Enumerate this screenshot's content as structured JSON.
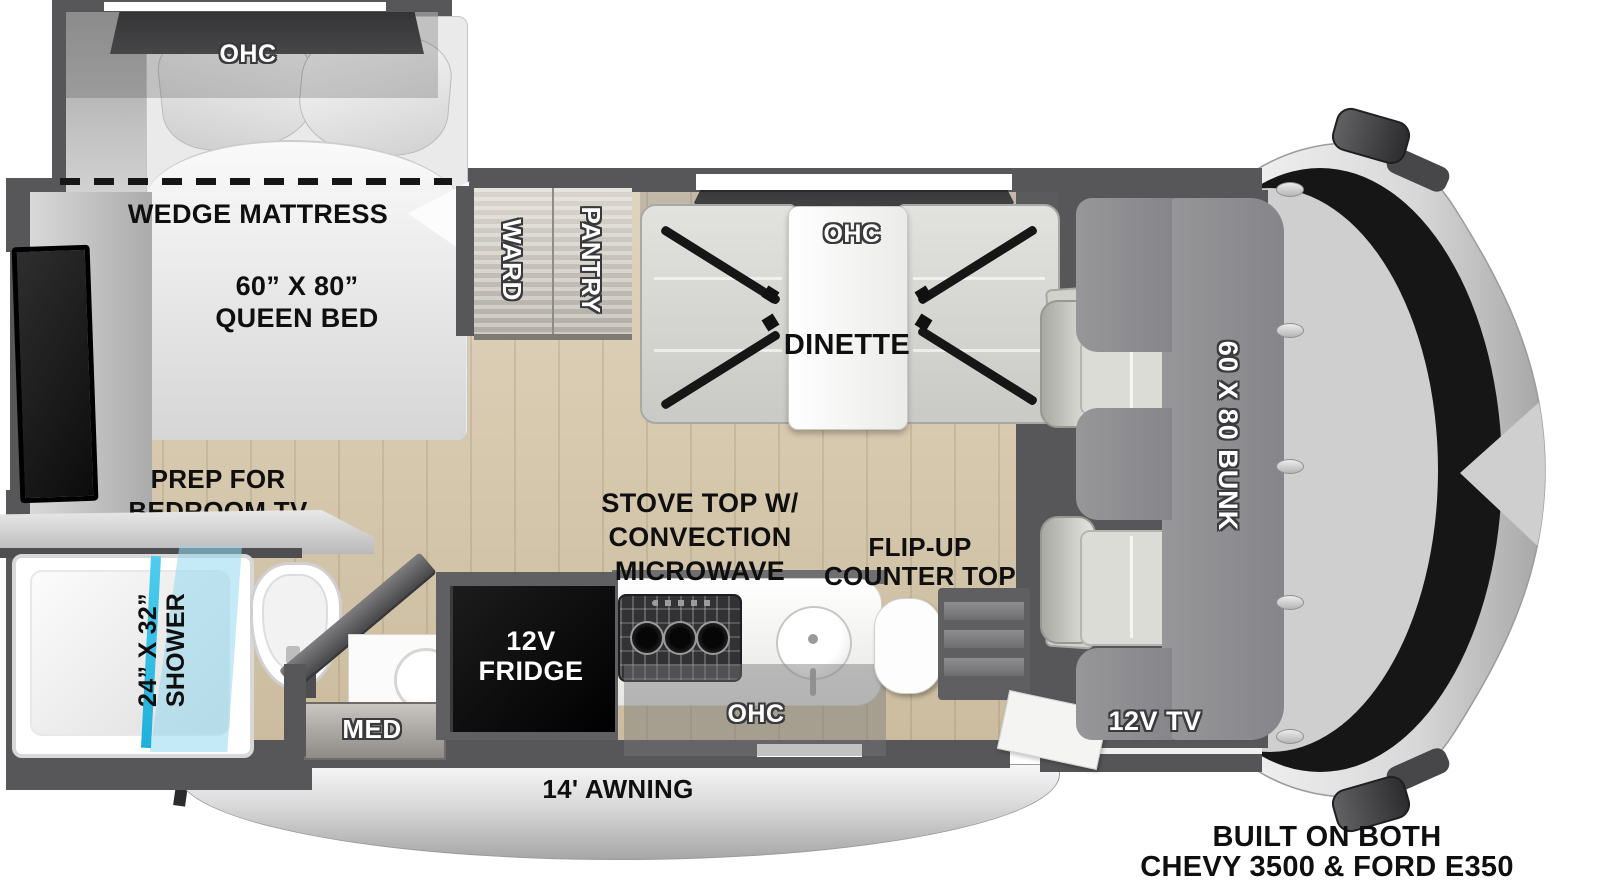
{
  "floorplan": {
    "bedroom": {
      "ohc": "OHC",
      "wedge_mattress": "WEDGE MATTRESS",
      "bed_size": "60” X 80”",
      "bed_type": "QUEEN BED",
      "prep_line1": "PREP FOR",
      "prep_line2": "BEDROOM TV"
    },
    "bathroom": {
      "shower_size": "24” X 32”",
      "shower_label": "SHOWER",
      "med": "MED"
    },
    "storage": {
      "ward": "WARD",
      "pantry": "PANTRY"
    },
    "dinette": {
      "ohc": "OHC",
      "label": "DINETTE"
    },
    "kitchen": {
      "fridge_line1": "12V",
      "fridge_line2": "FRIDGE",
      "stove_line1": "STOVE TOP W/",
      "stove_line2": "CONVECTION",
      "stove_line3": "MICROWAVE",
      "flip_line1": "FLIP-UP",
      "flip_line2": "COUNTER TOP",
      "ohc": "OHC"
    },
    "cab": {
      "bunk": "60 X 80 BUNK",
      "tv": "12V TV"
    },
    "exterior": {
      "awning": "14' AWNING",
      "chassis_line1": "BUILT ON BOTH",
      "chassis_line2": "CHEVY 3500 & FORD E350"
    },
    "colors": {
      "wall": "#57575a",
      "wood": "#d8c8a9",
      "glass_accent": "#35c4e9",
      "bunk": "#8d8d90"
    }
  }
}
